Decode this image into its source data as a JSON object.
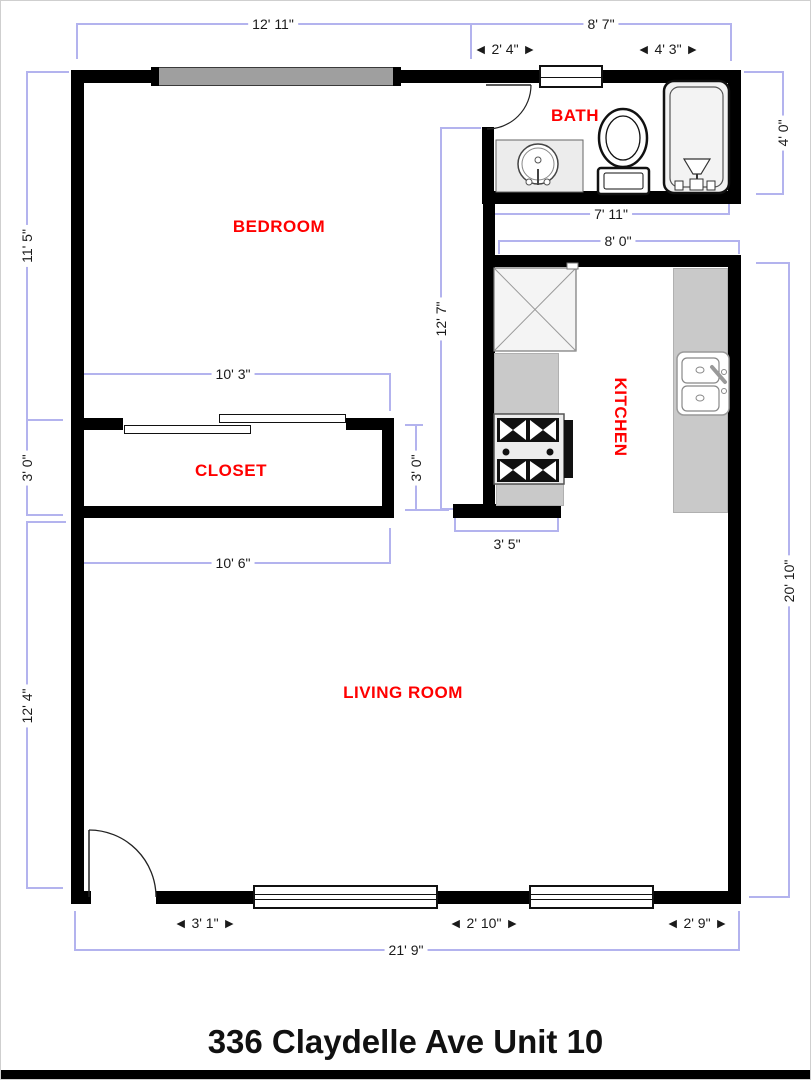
{
  "title": "336 Claydelle Ave Unit 10",
  "rooms": {
    "bedroom": "BEDROOM",
    "bath": "BATH",
    "closet": "CLOSET",
    "kitchen": "KITCHEN",
    "living": "LIVING ROOM"
  },
  "dims": {
    "w12_11": "12' 11\"",
    "w8_7": "8' 7\"",
    "w2_4": "◄ 2' 4\" ►",
    "w4_3": "◄ 4' 3\" ►",
    "h4_0": "4' 0\"",
    "h11_5": "11' 5\"",
    "w7_11": "7' 11\"",
    "w8_0": "8' 0\"",
    "h12_7": "12' 7\"",
    "w10_3": "10' 3\"",
    "h3_0_left": "3' 0\"",
    "h3_0_right": "3' 0\"",
    "w10_6": "10' 6\"",
    "w3_5": "3' 5\"",
    "h12_4": "12' 4\"",
    "h20_10": "20' 10\"",
    "w3_1": "◄ 3' 1\" ►",
    "w2_10": "◄ 2' 10\" ►",
    "w2_9": "◄ 2' 9\" ►",
    "w21_9": "21' 9\""
  },
  "colors": {
    "wall": "#000000",
    "dim_line": "#b3b3ee",
    "room_label": "#ff0000",
    "counter": "#c9c9c9",
    "window_gray": "#9f9f9f"
  }
}
